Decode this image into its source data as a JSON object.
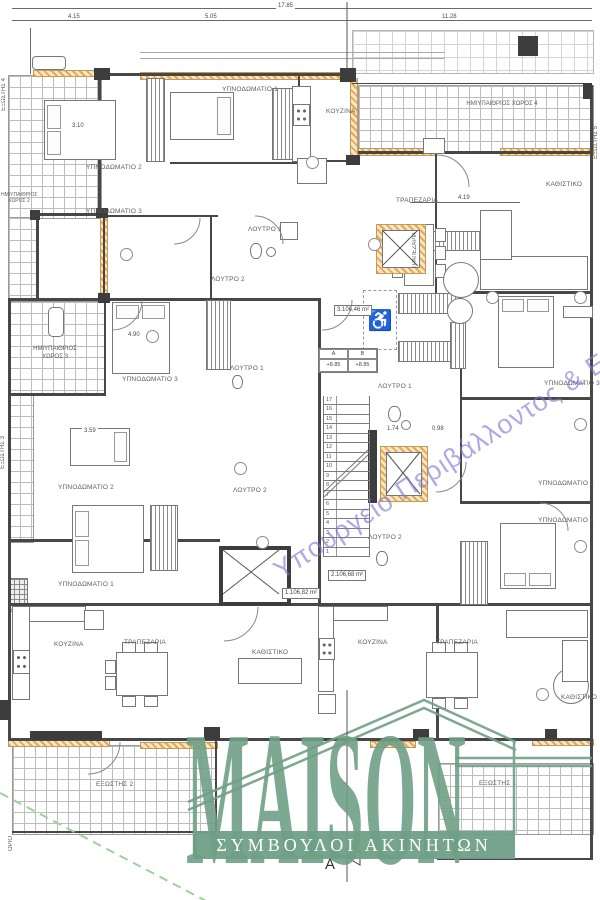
{
  "dims": {
    "top_total": "17.85",
    "top": [
      "4.15",
      "5.05",
      "11.28"
    ],
    "inner": [
      "4.19",
      "3.10",
      "4.90",
      "3.59",
      "1.74",
      "0.98"
    ]
  },
  "labels": {
    "bedroom1_tl": "ΥΠΝΟΔΩΜΑΤΙΟ 1",
    "bedroom2_tl": "ΥΠΝΟΔΩΜΑΤΙΟ 2",
    "bedroom3_tl": "ΥΠΝΟΔΩΜΑΤΙΟ 3",
    "kitchen_tl": "ΚΟΥΖΙΝΑ",
    "bath1_tl": "ΛΟΥΤΡΟ 1",
    "bath2_tl": "ΛΟΥΤΡΟ 2",
    "semi_open_4": "ΗΜΙΥΠΑΙΘΡΙΟΣ ΧΩΡΟΣ 4",
    "living_tr": "ΚΑΘΙΣΤΙΚΟ",
    "dining_tr": "ΤΡΑΠΕΖΑΡΙΑ",
    "dining_tr_table": "ΤΡΑΠΕΖΑΡΙΑ",
    "balcony4": "ΕΞΩΣΤΗΣ 4",
    "semi_open_2": "ΗΜΙΥΠΑΙΘΡΙΟΣ ΧΩΡΟΣ 2",
    "semi_open_3": "ΗΜΙΥΠΑΙΘΡΙΟΣ ΧΩΡΟΣ 3",
    "balcony3": "ΕΞΩΣΤΗΣ 3",
    "balcony5": "ΕΞΩΣΤΗΣ 5",
    "bedroom3_ml": "ΥΠΝΟΔΩΜΑΤΙΟ 3",
    "bath1_ml": "ΛΟΥΤΡΟ 1",
    "bedroom2_ml": "ΥΠΝΟΔΩΜΑΤΙΟ 2",
    "bedroom1_ml": "ΥΠΝΟΔΩΜΑΤΙΟ 1",
    "bath2_ml": "ΛΟΥΤΡΟ 2",
    "bath1_c": "ΛΟΥΤΡΟ 1",
    "bath2_c": "ΛΟΥΤΡΟ 2",
    "bedroom3_r": "ΥΠΝΟΔΩΜΑΤΙΟ 3",
    "bedroom2_r": "ΥΠΝΟΔΩΜΑΤΙΟ 2",
    "bedroom1_r": "ΥΠΝΟΔΩΜΑΤΙΟ 1",
    "kitchen_bl": "ΚΟΥΖΙΝΑ",
    "dining_bl": "ΤΡΑΠΕΖΑΡΙΑ",
    "living_bl": "ΚΑΘΙΣΤΙΚΟ",
    "kitchen_br": "ΚΟΥΖΙΝΑ",
    "dining_br": "ΤΡΑΠΕΖΑΡΙΑ",
    "living_br": "ΚΑΘΙΣΤΙΚΟ",
    "balcony2": "ΕΞΩΣΤΗΣ 2",
    "balcony1": "ΕΞΩΣΤΗΣ 1",
    "boundary": "ΟΡΙΟ"
  },
  "areas": {
    "apt3": "3.106,46 m²",
    "apt2": "2.106,68 m²",
    "apt1": "1.106,82 m²"
  },
  "stairs": {
    "numbers": [
      "17",
      "16",
      "15",
      "14",
      "13",
      "12",
      "11",
      "10",
      "9",
      "8",
      "7",
      "6",
      "5",
      "4",
      "3",
      "2",
      "1"
    ]
  },
  "levels": {
    "col_a": "A",
    "col_b": "B",
    "val_a": "+8.85",
    "val_b": "+8.85"
  },
  "icons": {
    "wheelchair": "♿"
  },
  "watermark": {
    "text": "Υπουργείο Περιβάλλοντος & Ενέργειας",
    "color": "#7e78d1"
  },
  "logo": {
    "name": "MAISON",
    "tagline": "ΣΥΜΒΟΥΛΟΙ ΑΚΙΝΗΤΩΝ",
    "color": "#6f9f86"
  },
  "section": {
    "label": "A"
  },
  "colors": {
    "hatch": "#e2a95e",
    "wall": "#474747",
    "tile_line": "#bdbdbd"
  }
}
